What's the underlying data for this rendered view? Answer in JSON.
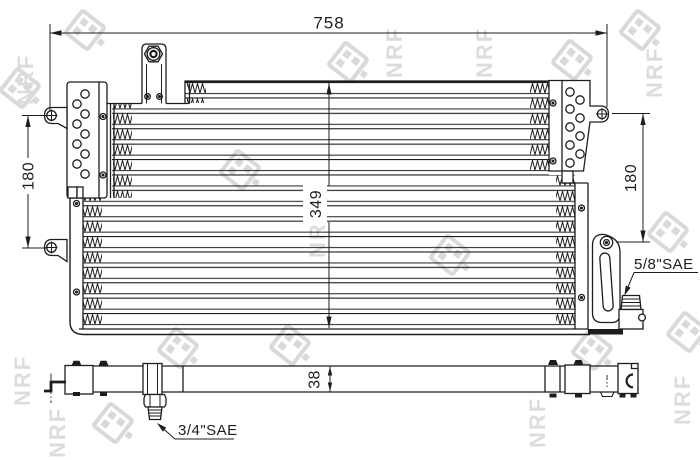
{
  "watermark": {
    "text": "NRF"
  },
  "dimensions": {
    "overall_width": "758",
    "left_mount_height": "180",
    "core_height": "349",
    "right_mount_height": "180",
    "depth": "38"
  },
  "fittings": {
    "upper": "5/8\"SAE",
    "lower": "3/4\"SAE"
  },
  "colors": {
    "line": "#1d1d1d",
    "watermark": "#dcdcdc",
    "background": "#ffffff"
  }
}
